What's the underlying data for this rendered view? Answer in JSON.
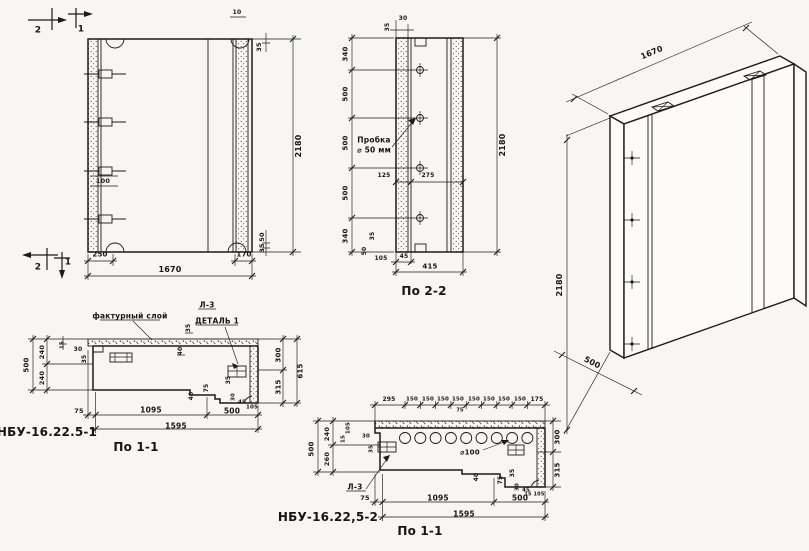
{
  "palette": {
    "paper": "#f7f6f2",
    "ink": "#1b1b1b"
  },
  "labels": {
    "front": [
      {
        "t": "2",
        "x": 38,
        "y": 31,
        "s": 9,
        "n": "section-cut-mark-2"
      },
      {
        "t": "1",
        "x": 81,
        "y": 30,
        "s": 9,
        "n": "section-cut-mark-1"
      },
      {
        "t": "10",
        "x": 237,
        "y": 13,
        "s": 6
      },
      {
        "t": "35",
        "x": 259,
        "y": 47,
        "r": -90,
        "s": 6.5
      },
      {
        "t": "100",
        "x": 103,
        "y": 181,
        "s": 6.5
      },
      {
        "t": "50",
        "x": 262,
        "y": 237,
        "r": -90,
        "s": 6.5
      },
      {
        "t": "35",
        "x": 262,
        "y": 248,
        "r": -90,
        "s": 6.5
      },
      {
        "t": "2",
        "x": 38,
        "y": 268,
        "s": 9,
        "n": "section-cut-mark-2"
      },
      {
        "t": "1",
        "x": 68,
        "y": 263,
        "s": 9,
        "n": "section-cut-mark-1"
      },
      {
        "t": "250",
        "x": 100,
        "y": 255,
        "s": 7
      },
      {
        "t": "170",
        "x": 244,
        "y": 255,
        "s": 7
      },
      {
        "t": "1670",
        "x": 170,
        "y": 270,
        "s": 8
      },
      {
        "t": "2180",
        "x": 299,
        "y": 146,
        "r": -90,
        "s": 8
      }
    ],
    "section22": [
      {
        "t": "35",
        "x": 388,
        "y": 27,
        "r": -90,
        "s": 6
      },
      {
        "t": "30",
        "x": 403,
        "y": 19,
        "s": 6
      },
      {
        "t": "340",
        "x": 346,
        "y": 54,
        "r": -90,
        "s": 7
      },
      {
        "t": "500",
        "x": 346,
        "y": 94,
        "r": -90,
        "s": 7
      },
      {
        "t": "500",
        "x": 346,
        "y": 143,
        "r": -90,
        "s": 7
      },
      {
        "t": "500",
        "x": 346,
        "y": 193,
        "r": -90,
        "s": 7
      },
      {
        "t": "340",
        "x": 346,
        "y": 236,
        "r": -90,
        "s": 7
      },
      {
        "t": "2180",
        "x": 503,
        "y": 145,
        "r": -90,
        "s": 8
      },
      {
        "t": "Пробка",
        "x": 374,
        "y": 140,
        "s": 7.5,
        "n": "note-plug"
      },
      {
        "t": "⌀ 50 мм",
        "x": 374,
        "y": 150,
        "s": 7.5,
        "n": "note-plug-size"
      },
      {
        "t": "125",
        "x": 384,
        "y": 176,
        "s": 6
      },
      {
        "t": "275",
        "x": 428,
        "y": 176,
        "s": 6
      },
      {
        "t": "35",
        "x": 373,
        "y": 236,
        "r": -90,
        "s": 6
      },
      {
        "t": "50",
        "x": 365,
        "y": 251,
        "r": -90,
        "s": 6
      },
      {
        "t": "105",
        "x": 381,
        "y": 259,
        "s": 6
      },
      {
        "t": "45",
        "x": 404,
        "y": 257,
        "s": 6
      },
      {
        "t": "415",
        "x": 430,
        "y": 267,
        "s": 7
      },
      {
        "t": "По 2-2",
        "x": 424,
        "y": 291,
        "s": 12,
        "n": "view-title-section-2-2"
      }
    ],
    "iso": [
      {
        "t": "1670",
        "x": 652,
        "y": 53,
        "r": -23,
        "s": 8
      },
      {
        "t": "2180",
        "x": 560,
        "y": 285,
        "r": -90,
        "s": 8
      },
      {
        "t": "500",
        "x": 592,
        "y": 363,
        "r": 27,
        "s": 8
      }
    ],
    "section11a": [
      {
        "t": "фактурный слой",
        "x": 130,
        "y": 316,
        "s": 7.5,
        "n": "note-facing-layer"
      },
      {
        "t": "Л-3",
        "x": 207,
        "y": 305,
        "s": 7.5,
        "n": "note-l3"
      },
      {
        "t": "ДЕТАЛЬ 1",
        "x": 217,
        "y": 321,
        "s": 7.5,
        "n": "note-detail-1"
      },
      {
        "t": "35",
        "x": 189,
        "y": 328,
        "r": -90,
        "s": 6
      },
      {
        "t": "40",
        "x": 181,
        "y": 351,
        "r": -90,
        "s": 6
      },
      {
        "t": "500",
        "x": 27,
        "y": 365,
        "r": -90,
        "s": 7
      },
      {
        "t": "240",
        "x": 42,
        "y": 352,
        "r": -90,
        "s": 6.5
      },
      {
        "t": "240",
        "x": 42,
        "y": 378,
        "r": -90,
        "s": 6.5
      },
      {
        "t": "15",
        "x": 63,
        "y": 345,
        "r": -90,
        "s": 5.5
      },
      {
        "t": "30",
        "x": 78,
        "y": 350,
        "s": 6
      },
      {
        "t": "35",
        "x": 85,
        "y": 359,
        "r": -90,
        "s": 6
      },
      {
        "t": "40",
        "x": 192,
        "y": 396,
        "r": -90,
        "s": 6
      },
      {
        "t": "75",
        "x": 207,
        "y": 388,
        "r": -90,
        "s": 6
      },
      {
        "t": "35",
        "x": 229,
        "y": 380,
        "r": -90,
        "s": 6
      },
      {
        "t": "30",
        "x": 234,
        "y": 397,
        "r": -90,
        "s": 5.5
      },
      {
        "t": "45",
        "x": 242,
        "y": 403,
        "s": 5.5
      },
      {
        "t": "105",
        "x": 252,
        "y": 408,
        "s": 5.5
      },
      {
        "t": "300",
        "x": 279,
        "y": 355,
        "r": -90,
        "s": 7
      },
      {
        "t": "315",
        "x": 279,
        "y": 387,
        "r": -90,
        "s": 7
      },
      {
        "t": "615",
        "x": 301,
        "y": 371,
        "r": -90,
        "s": 7
      },
      {
        "t": "75",
        "x": 79,
        "y": 411,
        "s": 6.5
      },
      {
        "t": "1095",
        "x": 151,
        "y": 410,
        "s": 7.5
      },
      {
        "t": "500",
        "x": 232,
        "y": 411,
        "s": 7.5
      },
      {
        "t": "1595",
        "x": 176,
        "y": 426,
        "s": 7.5
      },
      {
        "t": "НБУ-16.22.5-1",
        "x": 47,
        "y": 432,
        "s": 12,
        "n": "panel-mark-label"
      },
      {
        "t": "По 1-1",
        "x": 136,
        "y": 447,
        "s": 12,
        "n": "view-title-section-1-1"
      }
    ],
    "section11b": [
      {
        "t": "295",
        "x": 389,
        "y": 400,
        "s": 6
      },
      {
        "t": "150",
        "x": 412,
        "y": 400,
        "s": 5.5
      },
      {
        "t": "150",
        "x": 428,
        "y": 400,
        "s": 5.5
      },
      {
        "t": "150",
        "x": 443,
        "y": 400,
        "s": 5.5
      },
      {
        "t": "150",
        "x": 458,
        "y": 400,
        "s": 5.5
      },
      {
        "t": "150",
        "x": 474,
        "y": 400,
        "s": 5.5
      },
      {
        "t": "150",
        "x": 489,
        "y": 400,
        "s": 5.5
      },
      {
        "t": "150",
        "x": 504,
        "y": 400,
        "s": 5.5
      },
      {
        "t": "150",
        "x": 520,
        "y": 400,
        "s": 5.5
      },
      {
        "t": "175",
        "x": 537,
        "y": 400,
        "s": 6
      },
      {
        "t": "75",
        "x": 460,
        "y": 411,
        "s": 5
      },
      {
        "t": "⌀100",
        "x": 470,
        "y": 453,
        "s": 7,
        "n": "note-diameter-100"
      },
      {
        "t": "Л-3",
        "x": 355,
        "y": 487,
        "s": 7.5,
        "n": "note-l3"
      },
      {
        "t": "500",
        "x": 312,
        "y": 449,
        "r": -90,
        "s": 7
      },
      {
        "t": "240",
        "x": 327,
        "y": 434,
        "r": -90,
        "s": 6.5
      },
      {
        "t": "260",
        "x": 327,
        "y": 459,
        "r": -90,
        "s": 6.5
      },
      {
        "t": "105",
        "x": 349,
        "y": 428,
        "r": -90,
        "s": 5.5
      },
      {
        "t": "15",
        "x": 344,
        "y": 439,
        "r": -90,
        "s": 5.5
      },
      {
        "t": "30",
        "x": 366,
        "y": 437,
        "s": 5.5
      },
      {
        "t": "35",
        "x": 372,
        "y": 449,
        "r": -90,
        "s": 5.5
      },
      {
        "t": "300",
        "x": 558,
        "y": 437,
        "r": -90,
        "s": 7
      },
      {
        "t": "315",
        "x": 558,
        "y": 470,
        "r": -90,
        "s": 7
      },
      {
        "t": "40",
        "x": 477,
        "y": 477,
        "r": -90,
        "s": 6
      },
      {
        "t": "75",
        "x": 501,
        "y": 480,
        "r": -90,
        "s": 6
      },
      {
        "t": "35",
        "x": 513,
        "y": 473,
        "r": -90,
        "s": 6
      },
      {
        "t": "30",
        "x": 518,
        "y": 487,
        "r": -90,
        "s": 5.5
      },
      {
        "t": "45",
        "x": 526,
        "y": 491,
        "s": 5.5
      },
      {
        "t": "15",
        "x": 528,
        "y": 495,
        "s": 5
      },
      {
        "t": "105",
        "x": 539,
        "y": 495,
        "s": 5
      },
      {
        "t": "75",
        "x": 365,
        "y": 498,
        "s": 6.5
      },
      {
        "t": "1095",
        "x": 438,
        "y": 498,
        "s": 7.5
      },
      {
        "t": "500",
        "x": 520,
        "y": 498,
        "s": 7.5
      },
      {
        "t": "1595",
        "x": 464,
        "y": 514,
        "s": 7.5
      },
      {
        "t": "НБУ-16.22,5-2",
        "x": 328,
        "y": 517,
        "s": 12,
        "n": "panel-mark-label"
      },
      {
        "t": "По 1-1",
        "x": 420,
        "y": 531,
        "s": 12,
        "n": "view-title-section-1-1"
      }
    ]
  }
}
